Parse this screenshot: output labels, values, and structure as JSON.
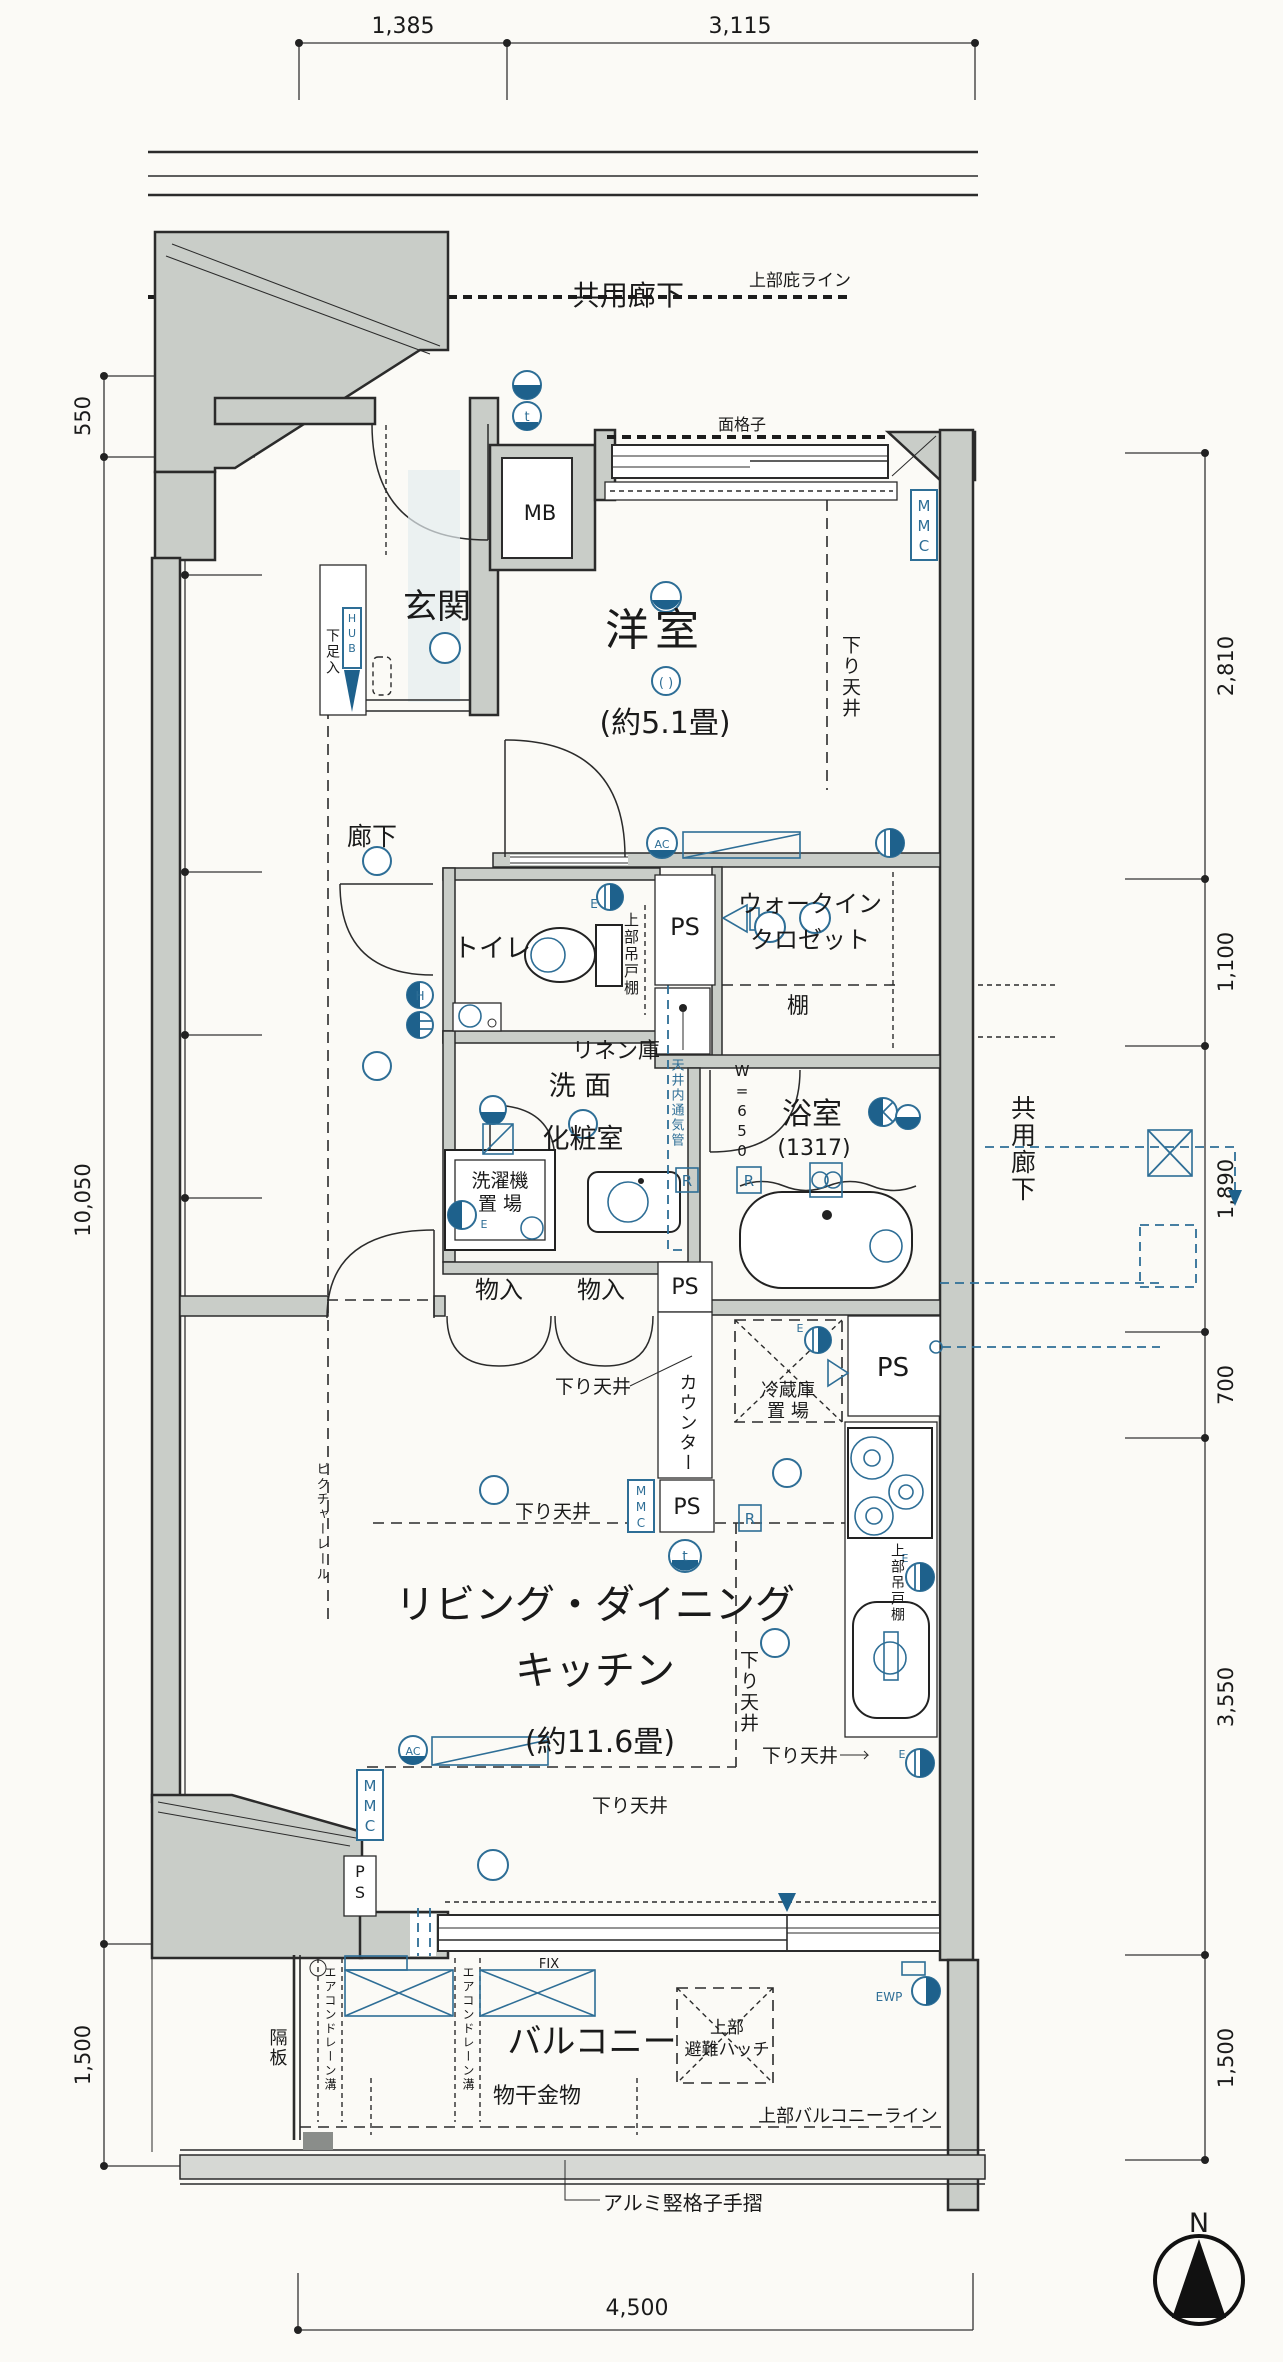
{
  "corridor_top": {
    "upper_eaves_line": "上部庇ライン",
    "shared_corridor": "共用廊下"
  },
  "dims": {
    "top": [
      "1,385",
      "3,115"
    ],
    "bottom": [
      "4,500"
    ],
    "left_outer": [
      "550",
      "10,050",
      "1,500"
    ],
    "left_inner": [
      "800",
      "2,010",
      "1,100",
      "1,100",
      "5,040"
    ],
    "right": [
      "2,810",
      "1,100",
      "1,890",
      "700",
      "3,550",
      "1,500"
    ]
  },
  "rooms": {
    "genkan": "玄関",
    "yoshitsu": "洋室",
    "yoshitsu_size": "(約5.1畳)",
    "rouka": "廊下",
    "toilet": "トイレ",
    "wic1": "ウォークイン",
    "wic2": "クロゼット",
    "tana": "棚",
    "linen": "リネン庫",
    "senmen1": "洗 面",
    "senmen2": "化粧室",
    "laundry1": "洗濯機",
    "laundry2": "置 場",
    "bath": "浴室",
    "bath_size": "(1317)",
    "monoire": "物入",
    "ldk1": "リビング・ダイニング",
    "ldk2": "キッチン",
    "ldk_size": "(約11.6畳)",
    "balcony": "バルコニー"
  },
  "labels": {
    "mb": "MB",
    "ps": "PS",
    "mmc": "MMC",
    "hub": "HUB",
    "getabako": "下足入",
    "menkoushi": "面格子",
    "kamoi": "上部吊戸棚",
    "vent": "天井内通気管",
    "w650": "W=650",
    "sagari": "下り天井",
    "counter": "カウンター",
    "fridge1": "冷蔵庫",
    "fridge2": "置 場",
    "picture_rail": "ピクチャーレール",
    "kakuiita": "隔板",
    "ac_drain": "エアコンドレーン溝",
    "fix": "FIX",
    "monohoshi": "物干金物",
    "hatch1": "上部",
    "hatch2": "避難ハッチ",
    "balcony_line": "上部バルコニーライン",
    "handrail": "アルミ竪格子手摺",
    "ewp": "EWP",
    "r": "R",
    "e": "E",
    "t": "t",
    "h": "H",
    "ac": "AC",
    "north": "N"
  },
  "colors": {
    "wall_fill": "#c9cdc8",
    "line": "#2b2b2b",
    "symbol_blue": "#2e6e96",
    "symbol_blue_fill": "#1e618c",
    "paper": "#fbfaf6"
  }
}
